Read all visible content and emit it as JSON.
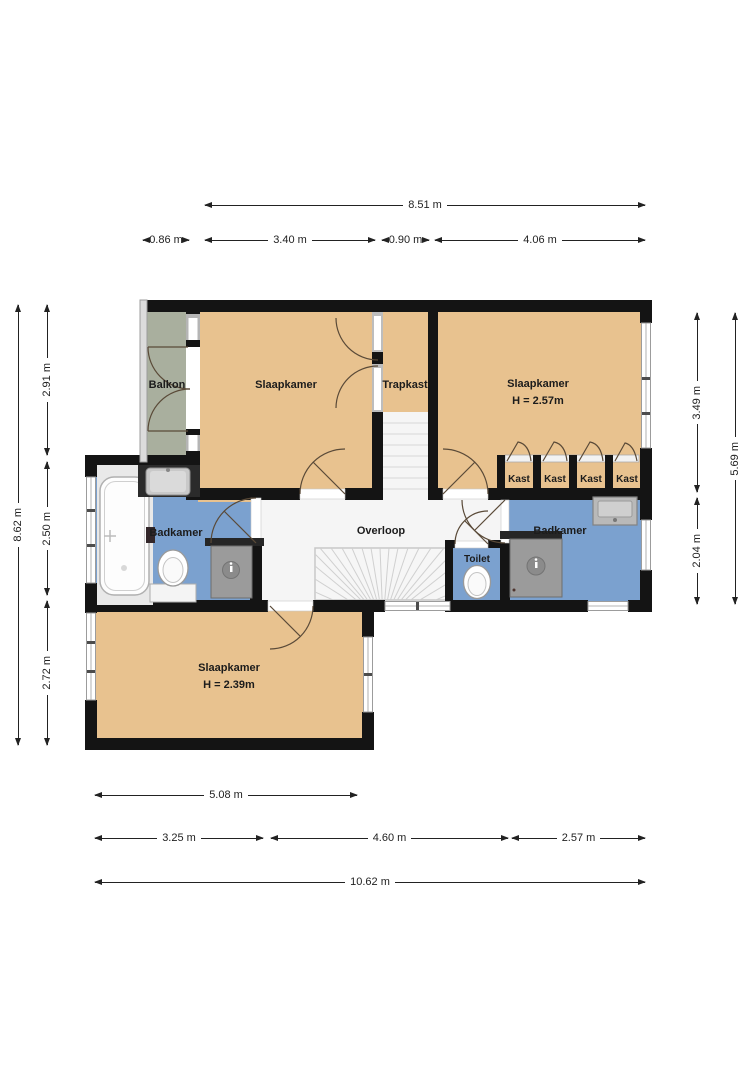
{
  "plan": {
    "rooms": {
      "balkon": {
        "label": "Balkon"
      },
      "slaapkamer_top_left": {
        "label": "Slaapkamer"
      },
      "trapkast": {
        "label": "Trapkast"
      },
      "slaapkamer_top_right": {
        "label": "Slaapkamer",
        "ceiling_height": "H = 2.57m"
      },
      "badkamer_left": {
        "label": "Badkamer"
      },
      "overloop": {
        "label": "Overloop"
      },
      "toilet": {
        "label": "Toilet"
      },
      "badkamer_right": {
        "label": "Badkamer"
      },
      "slaapkamer_bottom": {
        "label": "Slaapkamer",
        "ceiling_height": "H = 2.39m"
      },
      "closets": [
        {
          "label": "Kast"
        },
        {
          "label": "Kast"
        },
        {
          "label": "Kast"
        },
        {
          "label": "Kast"
        }
      ]
    },
    "dimensions": {
      "top_total": {
        "label": "8.51 m"
      },
      "top_segments": [
        {
          "label": "0.86 m"
        },
        {
          "label": "3.40 m"
        },
        {
          "label": "0.90 m"
        },
        {
          "label": "4.06 m"
        }
      ],
      "left_total": {
        "label": "8.62 m"
      },
      "left_segments": [
        {
          "label": "2.91 m"
        },
        {
          "label": "2.50 m"
        },
        {
          "label": "2.72 m"
        }
      ],
      "right_total": {
        "label": "5.69 m"
      },
      "right_segments": [
        {
          "label": "3.49 m"
        },
        {
          "label": "2.04 m"
        }
      ],
      "bottom_row1": {
        "label": "5.08 m"
      },
      "bottom_segments": [
        {
          "label": "3.25 m"
        },
        {
          "label": "4.60 m"
        },
        {
          "label": "2.57 m"
        }
      ],
      "bottom_total": {
        "label": "10.62 m"
      }
    },
    "colors": {
      "wall": "#141414",
      "room_floor": "#e8c28f",
      "bathroom_floor": "#7ba1cf",
      "balcony_floor": "#a9af9e",
      "landing_floor": "#f5f5f5",
      "shower_tray": "#9b9b9b",
      "door_line": "#5a4a38",
      "dimension_line": "#222222",
      "label_text": "#1c1c1c"
    }
  }
}
